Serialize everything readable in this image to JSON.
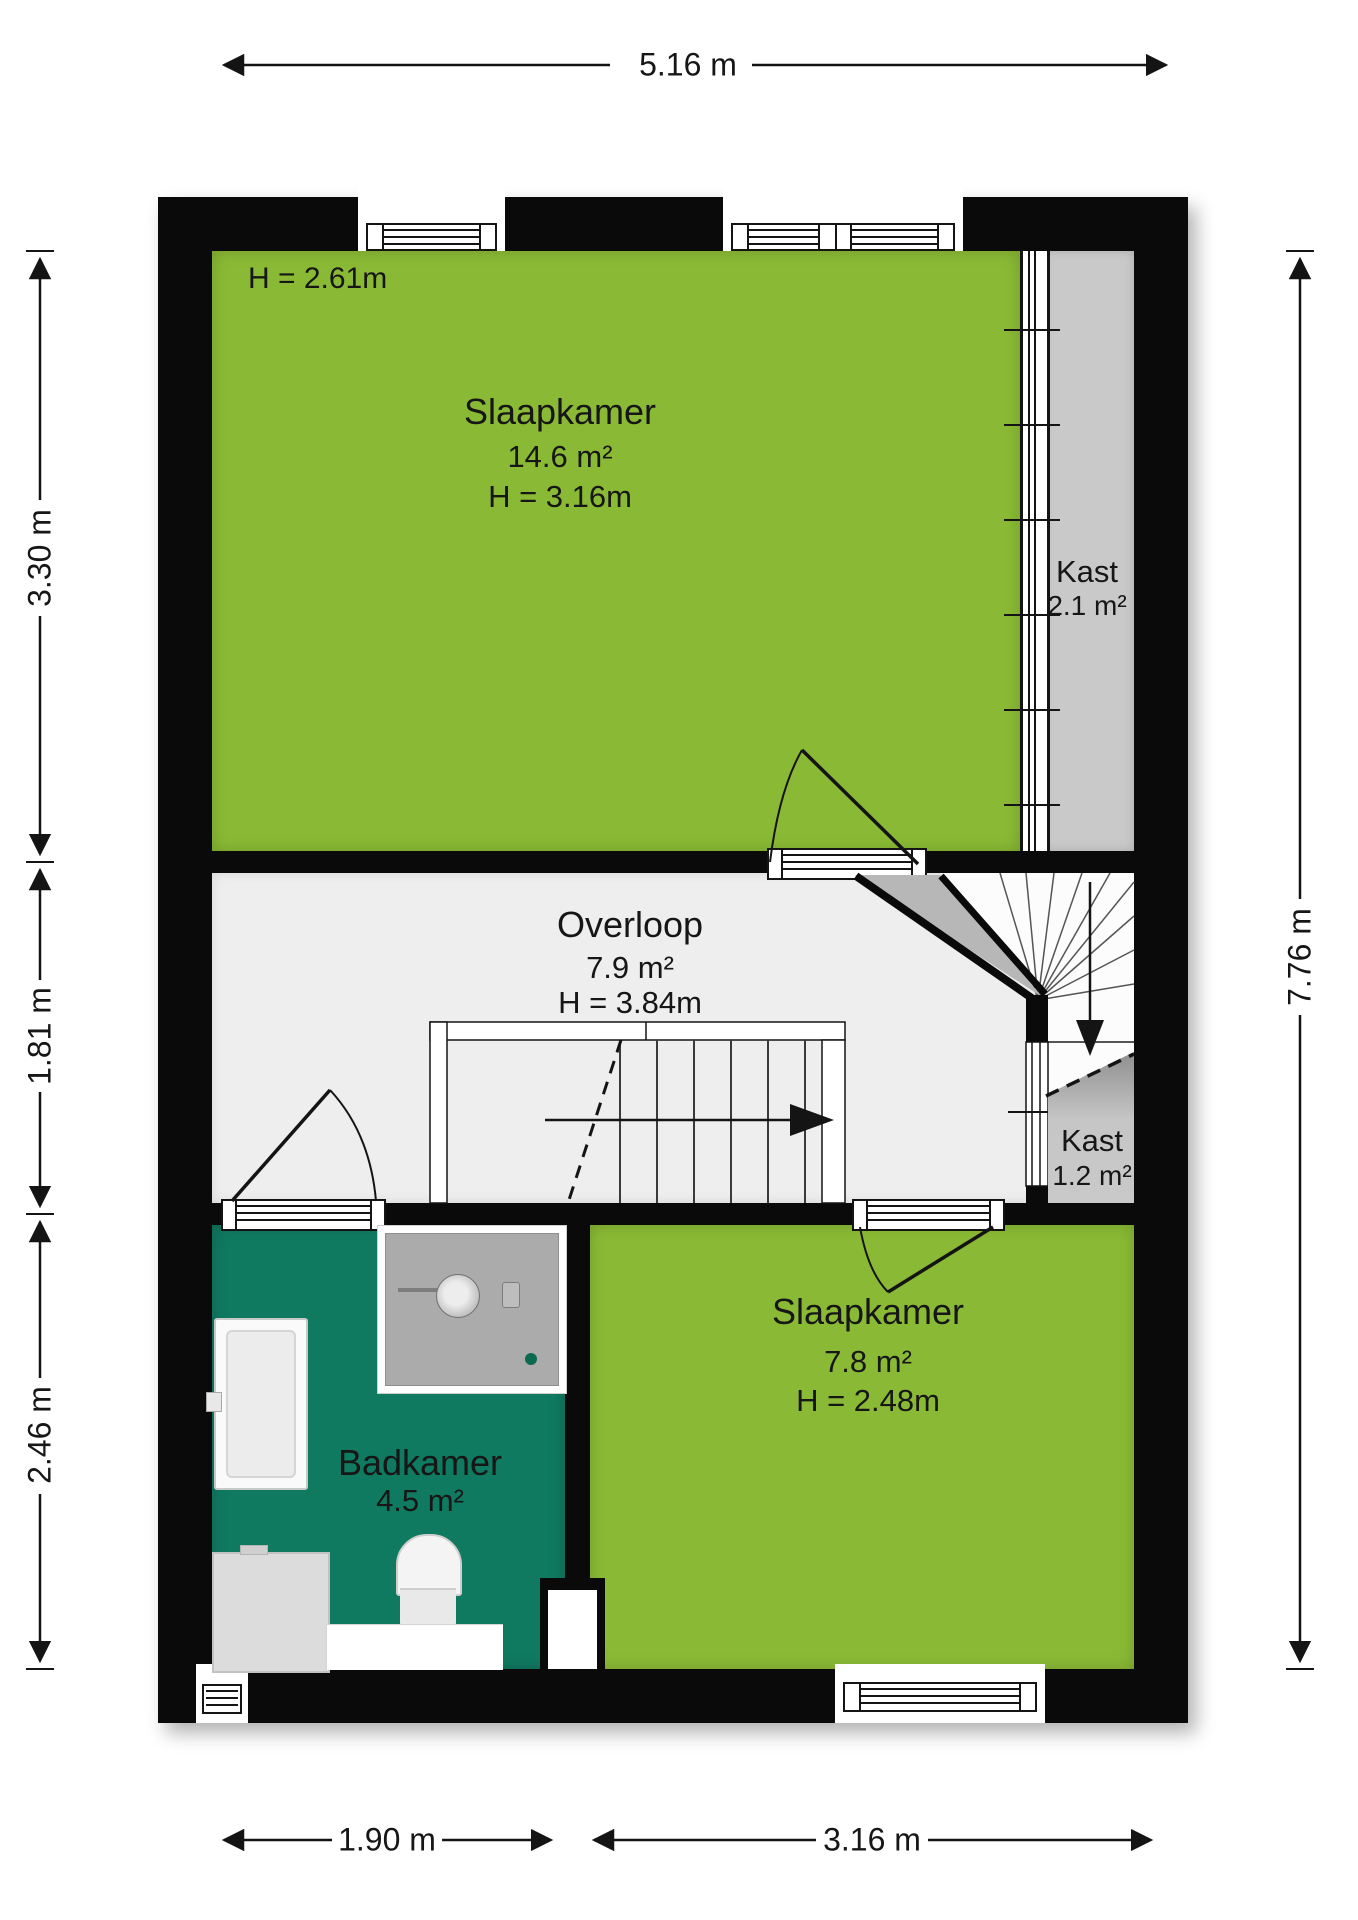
{
  "dimensions": {
    "top": "5.16 m",
    "left": [
      "3.30 m",
      "1.81 m",
      "2.46 m"
    ],
    "right": "7.76 m",
    "bottom": [
      "1.90 m",
      "3.16 m"
    ]
  },
  "rooms": {
    "slaapkamer1": {
      "name": "Slaapkamer",
      "area": "14.6 m²",
      "height": "H = 3.16m",
      "corner_note": "H = 2.61m"
    },
    "kast1": {
      "name": "Kast",
      "area": "2.1 m²"
    },
    "overloop": {
      "name": "Overloop",
      "area": "7.9 m²",
      "height": "H = 3.84m"
    },
    "kast2": {
      "name": "Kast",
      "area": "1.2 m²"
    },
    "badkamer": {
      "name": "Badkamer",
      "area": "4.5 m²"
    },
    "slaapkamer2": {
      "name": "Slaapkamer",
      "area": "7.8 m²",
      "height": "H = 2.48m"
    }
  },
  "colors": {
    "bedroom": "#8ABA35",
    "bathroom": "#107A61",
    "closet": "#C9C9C9",
    "hall": "#EEEEEE",
    "wall": "#0A0A0A"
  }
}
